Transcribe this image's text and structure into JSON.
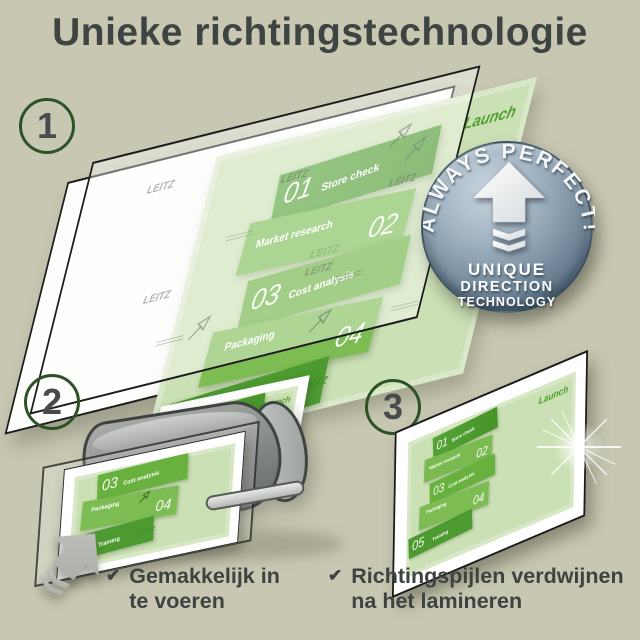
{
  "title": "Unieke richtingstechnologie",
  "step_numbers": [
    "1",
    "2",
    "3"
  ],
  "badge": {
    "arc_text": "ALWAYS PERFECT!",
    "line1": "UNIQUE",
    "line2": "DIRECTION",
    "line3": "TECHNOLOGY"
  },
  "document": {
    "watermark": "LEITZ",
    "launch_label": "Launch",
    "items": [
      {
        "num": "01",
        "label": "Store check"
      },
      {
        "num": "02",
        "label": "Market research"
      },
      {
        "num": "03",
        "label": "Cost analysis"
      },
      {
        "num": "04",
        "label": "Packaging"
      },
      {
        "num": "05",
        "label": "Training"
      }
    ]
  },
  "checklist": [
    {
      "mark": "✔",
      "line1": "Gemakkelijk in",
      "line2": "te voeren"
    },
    {
      "mark": "✔",
      "line1": "Richtingspijlen verdwijnen",
      "line2": "na het lamineren"
    }
  ],
  "colors": {
    "background": "#c8c8b2",
    "title_text": "#3d4441",
    "circle_border": "#2c5328",
    "green_dark": "#4c9a30",
    "green_mid": "#7aba50",
    "doc_green_light": "#cbe0b4",
    "launch_green": "#4da02e",
    "badge_blue": "#73899b",
    "machine_grey": "#8f938f"
  }
}
